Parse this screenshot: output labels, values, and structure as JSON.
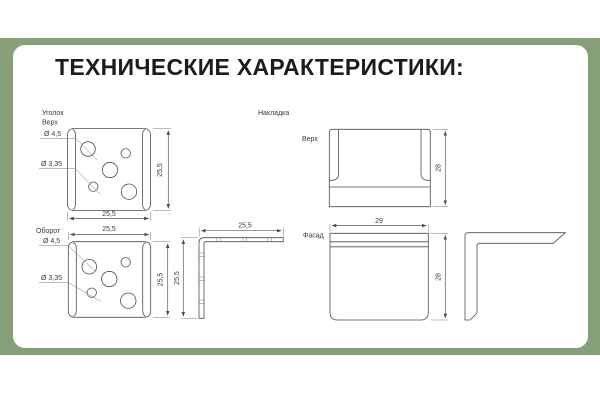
{
  "title": "ТЕХНИЧЕСКИЕ ХАРАКТЕРИСТИКИ:",
  "colors": {
    "frame_green": "#85A078",
    "card_white": "#FFFFFF",
    "line": "#4D4D4D",
    "text": "#3A3A3A",
    "title": "#1C1C1C"
  },
  "bracket": {
    "name": "Уголок",
    "top_view": {
      "label": "Верх",
      "dia_large": "Ø 4,5",
      "dia_small": "Ø 3,35",
      "dim_width": "25,5",
      "dim_height": "25,5"
    },
    "back_view": {
      "label": "Оборот",
      "dia_large": "Ø 4,5",
      "dia_small": "Ø 3,35",
      "dim_width": "25,5",
      "dim_height": "25,5"
    },
    "side_view": {
      "dim_width": "25,5",
      "dim_height": "25,5"
    }
  },
  "overlay": {
    "name": "Накладка",
    "top_view": {
      "label": "Верх",
      "dim_height": "28"
    },
    "front_view": {
      "label": "Фасад",
      "dim_width": "29",
      "dim_height": "28"
    }
  }
}
